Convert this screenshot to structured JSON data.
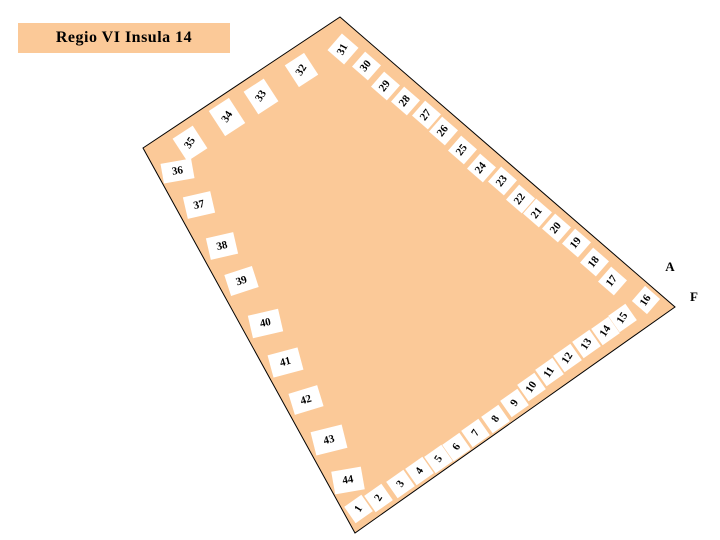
{
  "title": {
    "text": "Regio VI Insula 14"
  },
  "colors": {
    "insula_fill": "#FBC998",
    "outline": "#000000",
    "plot_box_bg": "#FFFFFF",
    "text": "#000000"
  },
  "map": {
    "outline_points": "340,17 675,307 355,533 143,148",
    "street_labels": [
      {
        "text": "A",
        "x": 670,
        "y": 267
      },
      {
        "text": "F",
        "x": 694,
        "y": 297
      }
    ],
    "plots": [
      {
        "n": "1",
        "x": 358,
        "y": 509,
        "w": 21,
        "h": 20,
        "br": -35,
        "tr": -57
      },
      {
        "n": "2",
        "x": 378,
        "y": 498,
        "w": 21,
        "h": 20,
        "br": -35,
        "tr": -57
      },
      {
        "n": "3",
        "x": 400,
        "y": 484,
        "w": 21,
        "h": 20,
        "br": -35,
        "tr": -57
      },
      {
        "n": "4",
        "x": 419,
        "y": 471,
        "w": 21,
        "h": 20,
        "br": -35,
        "tr": -57
      },
      {
        "n": "5",
        "x": 438,
        "y": 459,
        "w": 21,
        "h": 20,
        "br": -35,
        "tr": -57
      },
      {
        "n": "6",
        "x": 456,
        "y": 447,
        "w": 21,
        "h": 20,
        "br": -35,
        "tr": -57
      },
      {
        "n": "7",
        "x": 475,
        "y": 433,
        "w": 21,
        "h": 20,
        "br": -35,
        "tr": -57
      },
      {
        "n": "8",
        "x": 495,
        "y": 419,
        "w": 21,
        "h": 20,
        "br": -35,
        "tr": -57
      },
      {
        "n": "9",
        "x": 514,
        "y": 403,
        "w": 21,
        "h": 20,
        "br": -35,
        "tr": -57
      },
      {
        "n": "10",
        "x": 531,
        "y": 387,
        "w": 21,
        "h": 20,
        "br": -35,
        "tr": -57
      },
      {
        "n": "11",
        "x": 549,
        "y": 372,
        "w": 21,
        "h": 20,
        "br": -35,
        "tr": -57
      },
      {
        "n": "12",
        "x": 567,
        "y": 358,
        "w": 21,
        "h": 20,
        "br": -35,
        "tr": -57
      },
      {
        "n": "13",
        "x": 586,
        "y": 344,
        "w": 21,
        "h": 20,
        "br": -35,
        "tr": -57
      },
      {
        "n": "14",
        "x": 605,
        "y": 331,
        "w": 21,
        "h": 20,
        "br": -35,
        "tr": -57
      },
      {
        "n": "15",
        "x": 622,
        "y": 318,
        "w": 21,
        "h": 20,
        "br": -35,
        "tr": -57
      },
      {
        "n": "16",
        "x": 646,
        "y": 300,
        "w": 20,
        "h": 20,
        "br": 41,
        "tr": -57
      },
      {
        "n": "17",
        "x": 612,
        "y": 281,
        "w": 21,
        "h": 20,
        "br": 41,
        "tr": -52
      },
      {
        "n": "18",
        "x": 594,
        "y": 262,
        "w": 21,
        "h": 20,
        "br": 41,
        "tr": -52
      },
      {
        "n": "19",
        "x": 576,
        "y": 243,
        "w": 21,
        "h": 20,
        "br": 41,
        "tr": -52
      },
      {
        "n": "20",
        "x": 556,
        "y": 228,
        "w": 21,
        "h": 20,
        "br": 41,
        "tr": -52
      },
      {
        "n": "21",
        "x": 537,
        "y": 213,
        "w": 21,
        "h": 20,
        "br": 41,
        "tr": -52
      },
      {
        "n": "22",
        "x": 520,
        "y": 199,
        "w": 21,
        "h": 20,
        "br": 41,
        "tr": -52
      },
      {
        "n": "23",
        "x": 502,
        "y": 181,
        "w": 21,
        "h": 20,
        "br": 41,
        "tr": -52
      },
      {
        "n": "24",
        "x": 481,
        "y": 168,
        "w": 21,
        "h": 20,
        "br": 41,
        "tr": -52
      },
      {
        "n": "25",
        "x": 462,
        "y": 150,
        "w": 21,
        "h": 20,
        "br": 41,
        "tr": -52
      },
      {
        "n": "26",
        "x": 443,
        "y": 131,
        "w": 21,
        "h": 20,
        "br": 41,
        "tr": -52
      },
      {
        "n": "27",
        "x": 426,
        "y": 115,
        "w": 21,
        "h": 20,
        "br": 41,
        "tr": -52
      },
      {
        "n": "28",
        "x": 405,
        "y": 101,
        "w": 21,
        "h": 20,
        "br": 41,
        "tr": -52
      },
      {
        "n": "29",
        "x": 385,
        "y": 86,
        "w": 21,
        "h": 20,
        "br": 41,
        "tr": -52
      },
      {
        "n": "30",
        "x": 366,
        "y": 66,
        "w": 21,
        "h": 20,
        "br": 41,
        "tr": -52
      },
      {
        "n": "31",
        "x": 343,
        "y": 49,
        "w": 22,
        "h": 22,
        "br": 41,
        "tr": -62
      },
      {
        "n": "32",
        "x": 301,
        "y": 70,
        "w": 23,
        "h": 26,
        "br": -33,
        "tr": -57
      },
      {
        "n": "33",
        "x": 261,
        "y": 96,
        "w": 24,
        "h": 27,
        "br": -33,
        "tr": -57
      },
      {
        "n": "34",
        "x": 227,
        "y": 117,
        "w": 24,
        "h": 30,
        "br": -33,
        "tr": -57
      },
      {
        "n": "35",
        "x": 190,
        "y": 143,
        "w": 24,
        "h": 27,
        "br": -33,
        "tr": -57
      },
      {
        "n": "36",
        "x": 177,
        "y": 171,
        "w": 31,
        "h": 20,
        "br": -10,
        "tr": -10
      },
      {
        "n": "37",
        "x": 199,
        "y": 205,
        "w": 28,
        "h": 22,
        "br": -13,
        "tr": -13
      },
      {
        "n": "38",
        "x": 222,
        "y": 246,
        "w": 28,
        "h": 22,
        "br": -13,
        "tr": -13
      },
      {
        "n": "39",
        "x": 241,
        "y": 281,
        "w": 29,
        "h": 22,
        "br": -18,
        "tr": -18
      },
      {
        "n": "40",
        "x": 265,
        "y": 323,
        "w": 31,
        "h": 23,
        "br": -13,
        "tr": -13
      },
      {
        "n": "41",
        "x": 285,
        "y": 362,
        "w": 31,
        "h": 23,
        "br": -15,
        "tr": -15
      },
      {
        "n": "42",
        "x": 306,
        "y": 400,
        "w": 30,
        "h": 22,
        "br": -17,
        "tr": -17
      },
      {
        "n": "43",
        "x": 329,
        "y": 440,
        "w": 32,
        "h": 24,
        "br": -14,
        "tr": -14
      },
      {
        "n": "44",
        "x": 348,
        "y": 480,
        "w": 30,
        "h": 23,
        "br": -10,
        "tr": -10
      }
    ]
  }
}
